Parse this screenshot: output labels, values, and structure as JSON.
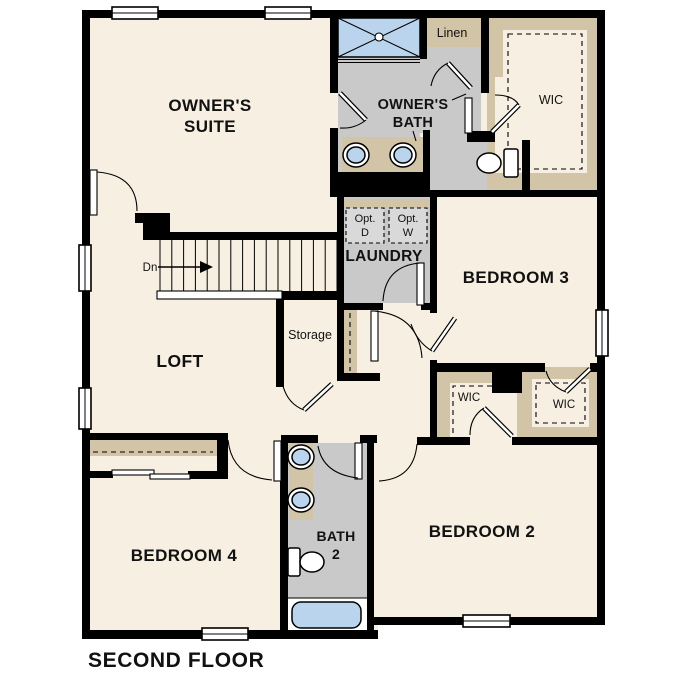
{
  "title": "SECOND FLOOR",
  "colors": {
    "floor": "#f7efe2",
    "wet": "#c9c9c9",
    "tan": "#d2c4a6",
    "blue": "#b9d4ec",
    "optbox": "#d9d9d9",
    "wall": "#000000"
  },
  "labels": {
    "owners_suite_1": "OWNER'S",
    "owners_suite_2": "SUITE",
    "owners_bath_1": "OWNER'S",
    "owners_bath_2": "BATH",
    "linen": "Linen",
    "wic_owner": "WIC",
    "opt_d_1": "Opt.",
    "opt_d_2": "D",
    "opt_w_1": "Opt.",
    "opt_w_2": "W",
    "laundry": "LAUNDRY",
    "bedroom3": "BEDROOM 3",
    "storage": "Storage",
    "loft": "LOFT",
    "stairs_down": "Dn",
    "wic_b3": "WIC",
    "wic_b2": "WIC",
    "bedroom4": "BEDROOM 4",
    "bath2_1": "BATH",
    "bath2_2": "2",
    "bedroom2": "BEDROOM 2"
  }
}
